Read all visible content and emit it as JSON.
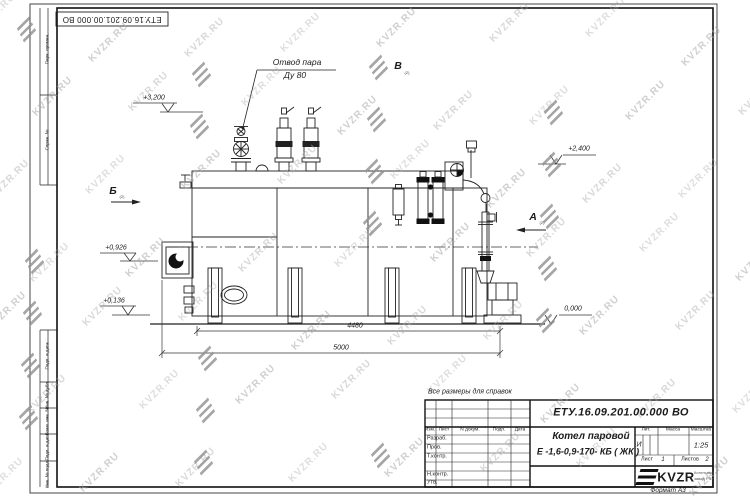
{
  "watermark": {
    "text": "KVZR.RU"
  },
  "frame_labels": [
    "Перв. примен.",
    "Справ. №",
    "Подп. и дата",
    "Инв. № дубл.",
    "Взам. инв. №",
    "Подп. и дата",
    "Инв. № подл."
  ],
  "note": "Все размеры для справок",
  "drawing": {
    "callout": {
      "line1": "Отвод пара",
      "line2": "Ду 80"
    },
    "views": {
      "b": {
        "letter": "Б",
        "note": "(2)"
      },
      "a": {
        "letter": "А",
        "note": "(2)"
      },
      "v": {
        "letter": "В",
        "note": "(2)"
      }
    },
    "elevations": {
      "e3200": "+3,200",
      "e2400": "+2,400",
      "e0926": "+0,926",
      "e0136": "+0,136",
      "e0000": "0,000"
    },
    "dimensions": {
      "d4480": "4480",
      "d5000": "5000"
    }
  },
  "titleblock": {
    "doc_number": "ЕТУ.16.09.201.00.000  ВО",
    "product_title": "Котел паровой",
    "product_code": "Е -1,6-0,9-170- КБ ( ЖК )",
    "cols": {
      "izm": "Изм.",
      "list": "Лист",
      "ndocum": "N докум.",
      "podp": "Подп.",
      "data": "Дата"
    },
    "rows": {
      "razrab": "Разраб.",
      "prov": "Пров.",
      "tkontr": "Т.контр.",
      "nkontr": "Н.контр.",
      "utv": "Утв."
    },
    "lit_header": "Лит.",
    "massa_header": "Масса",
    "masshtab_header": "Масштаб",
    "lit_value": "И",
    "scale_value": "1:25",
    "sheet_label": "Лист",
    "sheet_value": "1",
    "sheets_label": "Листов",
    "sheets_value": "2",
    "logo_text": "KVZR",
    "org_line1": "Котельный",
    "org_line2": "завод РЭУ",
    "format_label": "Формат А3"
  }
}
